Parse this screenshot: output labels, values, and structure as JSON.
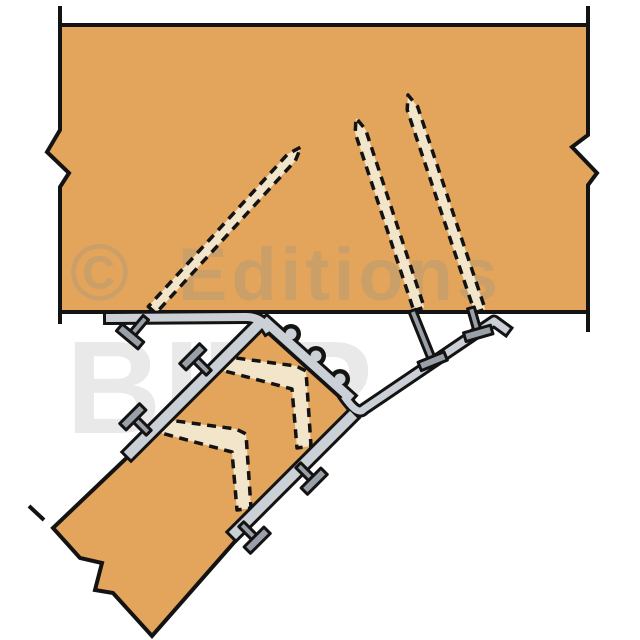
{
  "watermark": {
    "copyright_symbol": "©",
    "publisher_word": "Editions",
    "brand_word": "BILP"
  },
  "colors": {
    "background": "#ffffff",
    "wood": "#e3a45c",
    "outline": "#131313",
    "hidden_nail_fill": "#f3e5c9",
    "metal_light": "#cbd0d6",
    "metal_dark": "#9aa0a8",
    "watermark_on_wood": "#cb9f68",
    "watermark_on_white": "#e9e9e9"
  }
}
